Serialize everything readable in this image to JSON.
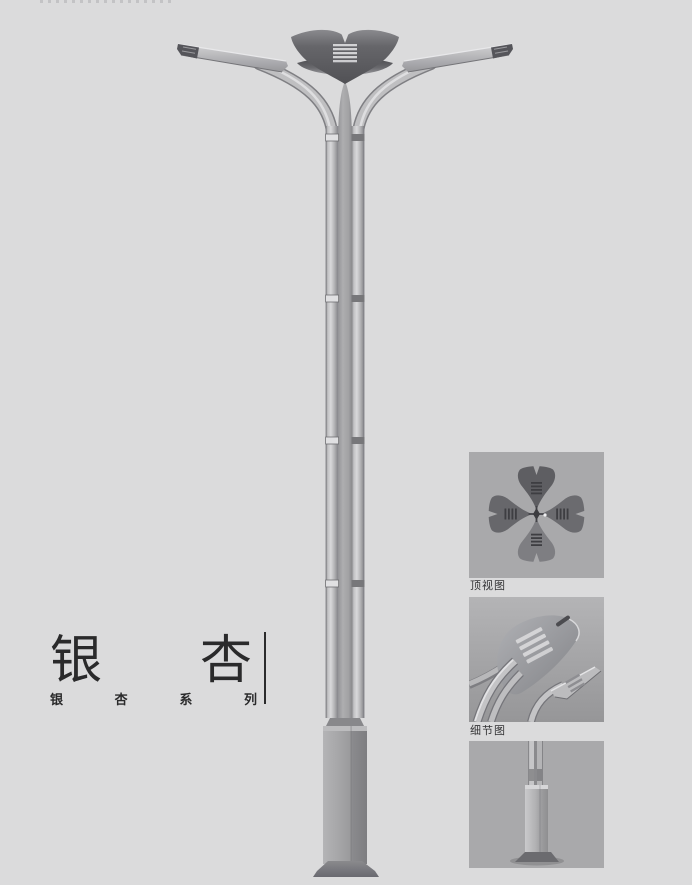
{
  "title": {
    "char_left": "银",
    "char_right": "杏"
  },
  "series": {
    "chars": [
      "银",
      "杏",
      "系",
      "列"
    ]
  },
  "panels": [
    {
      "label": "顶视图"
    },
    {
      "label": "细节图"
    },
    {
      "label": ""
    }
  ],
  "colors": {
    "page_bg": "#dbdbdc",
    "panel_bg": "#a9a9ab",
    "metal_light": "#d6d6d8",
    "metal_mid": "#a8a8aa",
    "crown_dark": "#5e5e62",
    "text": "#2b2b2c"
  }
}
